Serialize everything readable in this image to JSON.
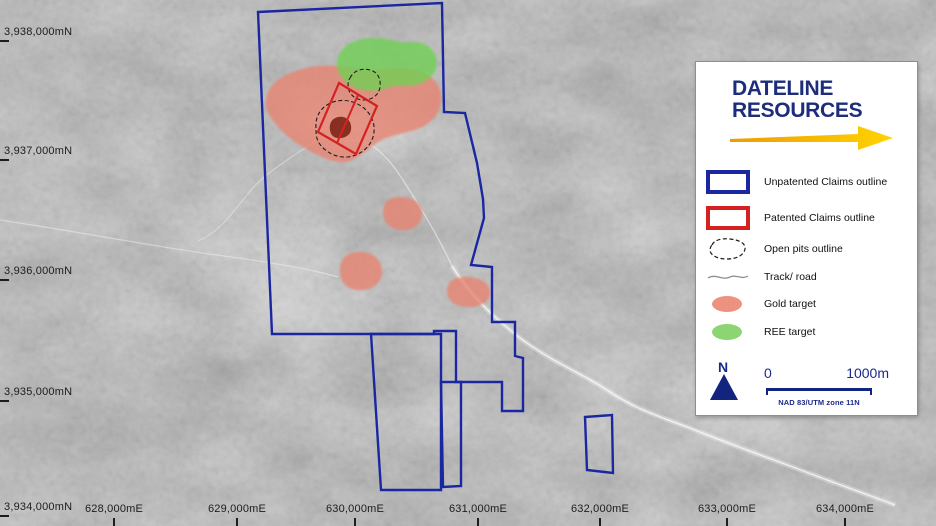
{
  "map": {
    "colors": {
      "unpatented_claims": "#1a27a0",
      "patented_claims": "#d42222",
      "gold_target": "#e8836f",
      "ree_target": "#6fd153",
      "pit_floor": "#7c2114"
    },
    "northing_labels": [
      {
        "text": "3,938,000mN",
        "y": 33
      },
      {
        "text": "3,937,000mN",
        "y": 152
      },
      {
        "text": "3,936,000mN",
        "y": 272
      },
      {
        "text": "3,935,000mN",
        "y": 393
      },
      {
        "text": "3,934,000mN",
        "y": 508
      }
    ],
    "easting_labels": [
      {
        "text": "628,000mE",
        "x": 114
      },
      {
        "text": "629,000mE",
        "x": 237
      },
      {
        "text": "630,000mE",
        "x": 355
      },
      {
        "text": "631,000mE",
        "x": 478
      },
      {
        "text": "632,000mE",
        "x": 600
      },
      {
        "text": "633,000mE",
        "x": 727
      },
      {
        "text": "634,000mE",
        "x": 845
      }
    ],
    "features": [
      {
        "name": "track-road-left",
        "d": "M0,220 C40,226 75,232 110,238 C145,244 180,250 210,254 C245,259 275,263 305,269 C318,272 328,274 338,277",
        "stroke": "rgba(240,240,240,0.5)",
        "sw": 1.3,
        "fill": "none"
      },
      {
        "name": "track-road-wash-halo",
        "d": "M452,266 C470,295 492,316 520,338 C555,364 582,373 610,392 C640,412 668,419 700,432 C740,448 772,459 806,472 C840,485 866,494 895,505",
        "stroke": "rgba(250,250,250,0.32)",
        "sw": 5,
        "fill": "none"
      },
      {
        "name": "track-road-wash",
        "d": "M452,266 C470,295 492,316 520,338 C555,364 582,373 610,392 C640,412 668,419 700,432 C740,448 772,459 806,472 C840,485 866,494 895,505",
        "stroke": "rgba(252,252,252,0.75)",
        "sw": 1.4,
        "fill": "none"
      },
      {
        "name": "track-road-to-pit",
        "d": "M452,266 C440,240 426,216 408,188 C398,172 390,160 378,150 C369,142 356,138 345,142",
        "stroke": "rgba(245,245,245,0.55)",
        "sw": 1.3,
        "fill": "none"
      },
      {
        "name": "track-road-west",
        "d": "M318,140 C300,151 281,163 263,178 C248,191 240,205 228,218 C219,229 209,236 198,241",
        "stroke": "rgba(240,240,240,0.45)",
        "sw": 1.2,
        "fill": "none"
      },
      {
        "name": "gold-target-main",
        "d": "M266,107 C264,93 272,82 286,75 C300,68 318,64 338,66 C352,67 362,72 374,70 C388,68 402,66 416,70 C430,74 440,82 441,96 C442,110 434,122 420,128 C406,134 392,134 380,141 C370,147 362,156 350,161 C338,165 322,158 308,150 C292,141 272,126 266,107 Z",
        "fill": "#e8836f",
        "opacity": 0.78,
        "blur": true
      },
      {
        "name": "ree-target",
        "d": "M337,66 C336,50 350,39 370,38 C388,37 398,44 410,42 C424,40 436,49 437,61 C438,72 430,80 419,84 C407,88 397,83 387,88 C376,93 360,91 350,85 C342,80 338,73 337,66 Z",
        "fill": "#6fd153",
        "opacity": 0.78,
        "blur": true
      },
      {
        "name": "gold-target-2",
        "d": "M383,212 C383,200 392,196 403,197 C415,198 423,205 422,215 C421,226 412,231 401,230 C390,229 383,223 383,212 Z",
        "fill": "#e8836f",
        "opacity": 0.78,
        "blur": true
      },
      {
        "name": "gold-target-3",
        "d": "M340,270 C340,256 350,251 362,252 C375,253 383,261 382,273 C381,285 370,291 358,290 C346,289 340,282 340,270 Z",
        "fill": "#e8836f",
        "opacity": 0.78,
        "blur": true
      },
      {
        "name": "gold-target-4",
        "d": "M447,291 C447,280 456,276 469,277 C482,278 491,284 490,294 C489,303 478,308 466,307 C454,306 447,300 447,291 Z",
        "fill": "#e8836f",
        "opacity": 0.78,
        "blur": true
      },
      {
        "name": "pit-floor",
        "d": "M330,125 C331,119 337,116 343,117 C349,118 352,124 351,130 C350,136 343,139 337,138 C331,137 329,131 330,125 Z",
        "fill": "#7c2114",
        "opacity": 0.88
      },
      {
        "name": "open-pit-outline-small",
        "d": "M350,78 C354,70 362,68 370,70 C378,72 381,79 380,87 C379,95 372,100 364,100 C355,100 349,94 348,87 C348,84 348,81 350,78 Z",
        "stroke": "#1c1c1c",
        "sw": 1.1,
        "dash": "4 2.5",
        "fill": "none"
      },
      {
        "name": "open-pit-outline-large",
        "d": "M316,128 C315,115 322,106 333,102 C345,98 358,102 366,110 C373,117 376,127 373,137 C370,147 361,155 348,157 C336,158 325,152 319,143 C316,138 316,133 316,128 Z",
        "stroke": "#1c1c1c",
        "sw": 1.1,
        "dash": "4 2.5",
        "fill": "none"
      },
      {
        "name": "patented-claims-outline",
        "d": "M339,83 L377,106 L356,154 L318,132 Z",
        "stroke": "#d42222",
        "sw": 2.2,
        "fill": "none"
      },
      {
        "name": "patented-claims-divider",
        "d": "M358,95 L337,143",
        "stroke": "#d42222",
        "sw": 2,
        "fill": "none"
      },
      {
        "name": "unpatented-claims-outline-main",
        "d": "M258,12 L442,3 L444,112 L465,113 L477,163 L483,199 L484,218 L471,265 L492,267 L492,322 L515,322 L515,356 L523,358 L523,411 L502,411 L502,382 L456,382 L456,331 L434,331 L434,334 L272,334 Z",
        "stroke": "#1a27a0",
        "sw": 2.4,
        "fill": "none"
      },
      {
        "name": "unpatented-claims-outline-prong-west",
        "d": "M371,334 L381,490 L441,490 L441,334 Z",
        "stroke": "#1a27a0",
        "sw": 2.4,
        "fill": "none"
      },
      {
        "name": "unpatented-claims-outline-prong-east",
        "d": "M441,382 L461,382 L461,486 L443,487 Z",
        "stroke": "#1a27a0",
        "sw": 2.4,
        "fill": "none"
      },
      {
        "name": "unpatented-claims-outline-southeast",
        "d": "M585,417 L612,415 L613,473 L587,470 Z",
        "stroke": "#1a27a0",
        "sw": 2.4,
        "fill": "none"
      }
    ]
  },
  "legend": {
    "logo_line1": "DATELINE",
    "logo_line2": "RESOURCES",
    "items": [
      {
        "label": "Unpatented Claims outline"
      },
      {
        "label": "Patented Claims outline"
      },
      {
        "label": "Open pits outline"
      },
      {
        "label": "Track/ road"
      },
      {
        "label": "Gold target"
      },
      {
        "label": "REE target"
      }
    ],
    "north_label": "N",
    "scale": {
      "start": "0",
      "end": "1000m",
      "datum": "NAD 83/UTM zone 11N"
    }
  }
}
